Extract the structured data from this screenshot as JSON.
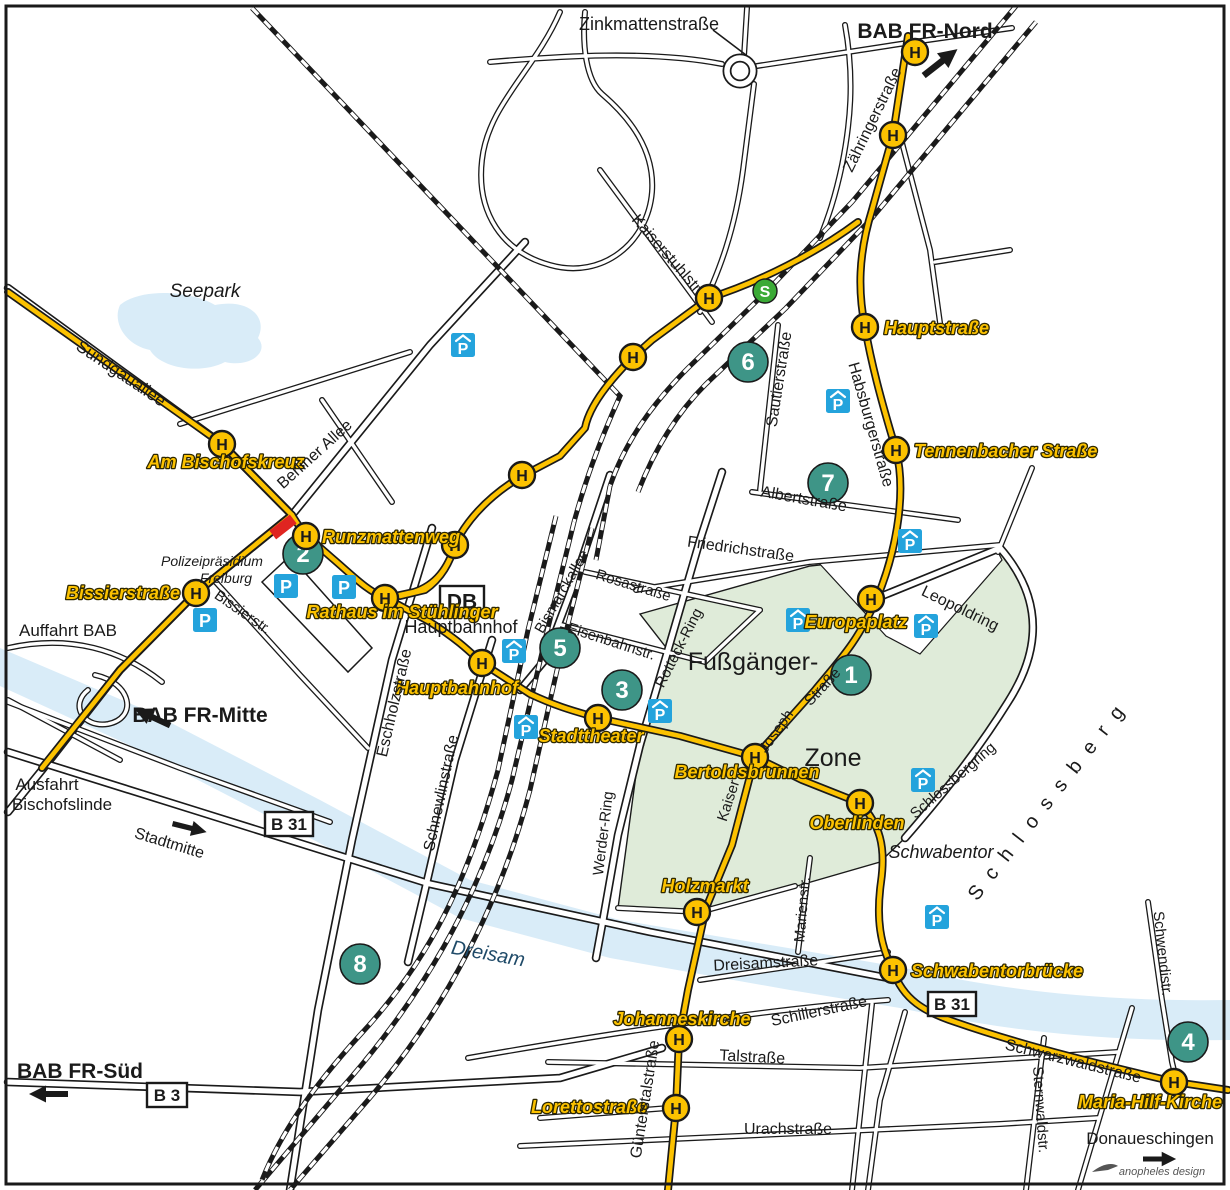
{
  "map": {
    "title": "Freiburg Innenstadt Anfahrtsplan",
    "colors": {
      "tram": "#FCC200",
      "stop_fill": "#FCC200",
      "teal": "#3E9587",
      "parking": "#24A3DC",
      "sbahn": "#3BAA36",
      "water": "#D9ECF8",
      "zone": "#DFEBD9",
      "casing": "#1a1a1a",
      "text": "#1a1a1a",
      "label_yellow": "#FCC200",
      "label_outline": "#2e2800",
      "red": "#E02521",
      "water_text": "#1F4A68"
    },
    "symbols": {
      "stop_char": "H",
      "parking_char": "P",
      "sbahn_char": "S"
    },
    "street_labels": [
      {
        "t": "Zinkmattenstraße",
        "x": 649,
        "y": 30,
        "r": 0,
        "fs": 18
      },
      {
        "t": "Kaiserstuhlstr.",
        "x": 664,
        "y": 258,
        "r": 49,
        "fs": 16
      },
      {
        "t": "Zähringerstraße",
        "x": 877,
        "y": 122,
        "r": -64,
        "fs": 16
      },
      {
        "t": "Sundgauallee",
        "x": 118,
        "y": 378,
        "r": 34,
        "fs": 17
      },
      {
        "t": "Berliner Allee",
        "x": 318,
        "y": 458,
        "r": -42,
        "fs": 16
      },
      {
        "t": "Bissierstr.",
        "x": 240,
        "y": 616,
        "r": 35,
        "fs": 15
      },
      {
        "t": "Eschholzstraße",
        "x": 399,
        "y": 704,
        "r": -77,
        "fs": 16
      },
      {
        "t": "Schnewlinstraße",
        "x": 446,
        "y": 794,
        "r": -78,
        "fs": 16
      },
      {
        "t": "Bismarckallee",
        "x": 566,
        "y": 594,
        "r": -60,
        "fs": 15
      },
      {
        "t": "Rosastraße",
        "x": 632,
        "y": 590,
        "r": 17,
        "fs": 15
      },
      {
        "t": "Eisenbahnstr.",
        "x": 610,
        "y": 646,
        "r": 18,
        "fs": 15
      },
      {
        "t": "Rotteck-Ring",
        "x": 683,
        "y": 650,
        "r": -63,
        "fs": 15
      },
      {
        "t": "Werder-Ring",
        "x": 608,
        "y": 834,
        "r": -83,
        "fs": 15
      },
      {
        "t": "Friedrichstraße",
        "x": 740,
        "y": 554,
        "r": 8,
        "fs": 16
      },
      {
        "t": "Sautierstraße",
        "x": 784,
        "y": 380,
        "r": -81,
        "fs": 16
      },
      {
        "t": "Albertstraße",
        "x": 803,
        "y": 504,
        "r": 10,
        "fs": 16
      },
      {
        "t": "Habsburgerstraße",
        "x": 866,
        "y": 426,
        "r": 74,
        "fs": 16
      },
      {
        "t": "Leopoldring",
        "x": 958,
        "y": 613,
        "r": 26,
        "fs": 16
      },
      {
        "t": "Schlossbergring",
        "x": 956,
        "y": 784,
        "r": -41,
        "fs": 15
      },
      {
        "t": "Marienstr.",
        "x": 807,
        "y": 910,
        "r": -85,
        "fs": 15
      },
      {
        "t": "Dreisamstraße",
        "x": 766,
        "y": 968,
        "r": -3,
        "fs": 16
      },
      {
        "t": "Schillerstraße",
        "x": 820,
        "y": 1016,
        "r": -12,
        "fs": 16
      },
      {
        "t": "Talstraße",
        "x": 752,
        "y": 1062,
        "r": 3,
        "fs": 16
      },
      {
        "t": "Urachstraße",
        "x": 788,
        "y": 1134,
        "r": 0,
        "fs": 16
      },
      {
        "t": "Günterstalstraße",
        "x": 650,
        "y": 1100,
        "r": -81,
        "fs": 16
      },
      {
        "t": "Sternwaldstr.",
        "x": 1036,
        "y": 1110,
        "r": 86,
        "fs": 15
      },
      {
        "t": "Schwendistr.",
        "x": 1158,
        "y": 954,
        "r": 84,
        "fs": 15
      },
      {
        "t": "Schwarzwaldstraße",
        "x": 1072,
        "y": 1066,
        "r": 14,
        "fs": 16
      },
      {
        "t": "Kaiser",
        "x": 733,
        "y": 802,
        "r": -72,
        "fs": 15
      },
      {
        "t": "Joseph",
        "x": 780,
        "y": 734,
        "r": -55,
        "fs": 15
      },
      {
        "t": "Straße",
        "x": 826,
        "y": 690,
        "r": -47,
        "fs": 15
      },
      {
        "t": "Stadtmitte",
        "x": 168,
        "y": 848,
        "r": 17,
        "fs": 16
      }
    ],
    "area_labels": [
      {
        "t": "Seepark",
        "x": 205,
        "y": 297,
        "fs": 19,
        "style": "italic"
      },
      {
        "t": "Polizeipräsidium",
        "x": 212,
        "y": 566,
        "fs": 14,
        "style": "italic"
      },
      {
        "t": "Freiburg",
        "x": 226,
        "y": 583,
        "fs": 14,
        "style": "italic"
      },
      {
        "t": "Hauptbahnhof",
        "x": 461,
        "y": 633,
        "fs": 18,
        "style": "plain"
      },
      {
        "t": "Fußgänger-",
        "x": 753,
        "y": 670,
        "fs": 25,
        "style": "plain"
      },
      {
        "t": "Zone",
        "x": 833,
        "y": 766,
        "fs": 25,
        "style": "plain"
      },
      {
        "t": "Schwabentor",
        "x": 941,
        "y": 858,
        "fs": 18,
        "style": "italic"
      },
      {
        "t": "Dreisam",
        "x": 487,
        "y": 960,
        "fs": 20,
        "style": "water",
        "r": 10
      },
      {
        "t": "Auffahrt BAB",
        "x": 68,
        "y": 636,
        "fs": 17,
        "style": "plain"
      },
      {
        "t": "Ausfahrt",
        "x": 47,
        "y": 790,
        "fs": 17,
        "style": "plain"
      },
      {
        "t": "Bischofslinde",
        "x": 62,
        "y": 810,
        "fs": 17,
        "style": "plain"
      },
      {
        "t": "Donaueschingen",
        "x": 1150,
        "y": 1144,
        "fs": 17,
        "style": "plain"
      },
      {
        "t": "BAB FR-Nord",
        "x": 925,
        "y": 38,
        "fs": 21,
        "style": "bold"
      },
      {
        "t": "BAB FR-Mitte",
        "x": 200,
        "y": 722,
        "fs": 21,
        "style": "bold"
      },
      {
        "t": "BAB FR-Süd",
        "x": 80,
        "y": 1078,
        "fs": 21,
        "style": "bold"
      },
      {
        "t": "Schlossberg",
        "x": 1055,
        "y": 802,
        "fs": 20,
        "style": "spread",
        "r": -52,
        "ls": 13
      }
    ],
    "stops": [
      {
        "x": 915,
        "y": 52
      },
      {
        "x": 893,
        "y": 135
      },
      {
        "x": 865,
        "y": 327
      },
      {
        "x": 709,
        "y": 298
      },
      {
        "x": 633,
        "y": 357
      },
      {
        "x": 522,
        "y": 475
      },
      {
        "x": 222,
        "y": 444
      },
      {
        "x": 306,
        "y": 536
      },
      {
        "x": 455,
        "y": 545
      },
      {
        "x": 896,
        "y": 450
      },
      {
        "x": 196,
        "y": 593
      },
      {
        "x": 385,
        "y": 598
      },
      {
        "x": 482,
        "y": 663
      },
      {
        "x": 871,
        "y": 599
      },
      {
        "x": 598,
        "y": 718
      },
      {
        "x": 755,
        "y": 757
      },
      {
        "x": 860,
        "y": 803
      },
      {
        "x": 697,
        "y": 912
      },
      {
        "x": 893,
        "y": 970
      },
      {
        "x": 679,
        "y": 1039
      },
      {
        "x": 676,
        "y": 1108
      },
      {
        "x": 1174,
        "y": 1082
      }
    ],
    "stop_labels": [
      {
        "t": "Hauptstraße",
        "x": 884,
        "y": 334,
        "a": "start"
      },
      {
        "t": "Am Bischofskreuz",
        "x": 226,
        "y": 468,
        "a": "middle"
      },
      {
        "t": "Runzmattenweg",
        "x": 322,
        "y": 543,
        "a": "start"
      },
      {
        "t": "Tennenbacher Straße",
        "x": 914,
        "y": 457,
        "a": "start"
      },
      {
        "t": "Bissierstraße",
        "x": 180,
        "y": 599,
        "a": "end"
      },
      {
        "t": "Rathaus im Stühlinger",
        "x": 402,
        "y": 618,
        "a": "middle"
      },
      {
        "t": "Hauptbahnhof",
        "x": 457,
        "y": 694,
        "a": "middle"
      },
      {
        "t": "Europaplatz",
        "x": 856,
        "y": 628,
        "a": "middle"
      },
      {
        "t": "Stadttheater",
        "x": 591,
        "y": 742,
        "a": "middle"
      },
      {
        "t": "Bertoldsbrunnen",
        "x": 747,
        "y": 778,
        "a": "middle"
      },
      {
        "t": "Oberlinden",
        "x": 857,
        "y": 829,
        "a": "middle"
      },
      {
        "t": "Holzmarkt",
        "x": 705,
        "y": 892,
        "a": "middle"
      },
      {
        "t": "Schwabentorbrücke",
        "x": 911,
        "y": 977,
        "a": "start"
      },
      {
        "t": "Johanneskirche",
        "x": 682,
        "y": 1025,
        "a": "middle"
      },
      {
        "t": "Lorettostraße",
        "x": 589,
        "y": 1113,
        "a": "middle"
      },
      {
        "t": "Maria-Hilf-Kirche",
        "x": 1150,
        "y": 1108,
        "a": "middle"
      }
    ],
    "numbered_markers": [
      {
        "n": "1",
        "x": 851,
        "y": 675
      },
      {
        "n": "2",
        "x": 303,
        "y": 554
      },
      {
        "n": "3",
        "x": 622,
        "y": 690
      },
      {
        "n": "4",
        "x": 1188,
        "y": 1042
      },
      {
        "n": "5",
        "x": 560,
        "y": 648
      },
      {
        "n": "6",
        "x": 748,
        "y": 362
      },
      {
        "n": "7",
        "x": 828,
        "y": 483
      },
      {
        "n": "8",
        "x": 360,
        "y": 964
      }
    ],
    "parking": [
      {
        "x": 286,
        "y": 586,
        "roof": false
      },
      {
        "x": 344,
        "y": 587,
        "roof": false
      },
      {
        "x": 205,
        "y": 620,
        "roof": false
      },
      {
        "x": 463,
        "y": 345,
        "roof": true
      },
      {
        "x": 838,
        "y": 401,
        "roof": true
      },
      {
        "x": 514,
        "y": 651,
        "roof": true
      },
      {
        "x": 526,
        "y": 727,
        "roof": true
      },
      {
        "x": 660,
        "y": 711,
        "roof": true
      },
      {
        "x": 798,
        "y": 620,
        "roof": true
      },
      {
        "x": 910,
        "y": 541,
        "roof": true
      },
      {
        "x": 926,
        "y": 626,
        "roof": true
      },
      {
        "x": 923,
        "y": 780,
        "roof": true
      },
      {
        "x": 937,
        "y": 917,
        "roof": true
      }
    ],
    "sbahn_badge": {
      "x": 765,
      "y": 291
    },
    "signs": [
      {
        "t": "B 31",
        "x": 289,
        "y": 824,
        "w": 48,
        "h": 24,
        "fs": 17
      },
      {
        "t": "B 31",
        "x": 952,
        "y": 1004,
        "w": 48,
        "h": 24,
        "fs": 17
      },
      {
        "t": "B 3",
        "x": 167,
        "y": 1095,
        "w": 40,
        "h": 24,
        "fs": 17
      },
      {
        "t": "DB",
        "x": 462,
        "y": 601,
        "w": 44,
        "h": 30,
        "fs": 21
      }
    ],
    "red_marker": {
      "x": 283,
      "y": 527,
      "r": -38
    },
    "arrows": [
      {
        "name": "bab-fr-nord-arrow",
        "x": 941,
        "y": 62,
        "r": -38,
        "s": 1.1
      },
      {
        "name": "bab-fr-mitte-arrow",
        "x": 152,
        "y": 717,
        "r": 205,
        "s": 1.0
      },
      {
        "name": "stadtmitte-arrow",
        "x": 190,
        "y": 828,
        "r": 14,
        "s": 0.9
      },
      {
        "name": "bab-fr-sued-arrow",
        "x": 48,
        "y": 1094,
        "r": 180,
        "s": 1.0
      },
      {
        "name": "donaueschingen-arrow",
        "x": 1160,
        "y": 1159,
        "r": 0,
        "s": 0.85
      }
    ],
    "logo_text": "anopheles design"
  }
}
